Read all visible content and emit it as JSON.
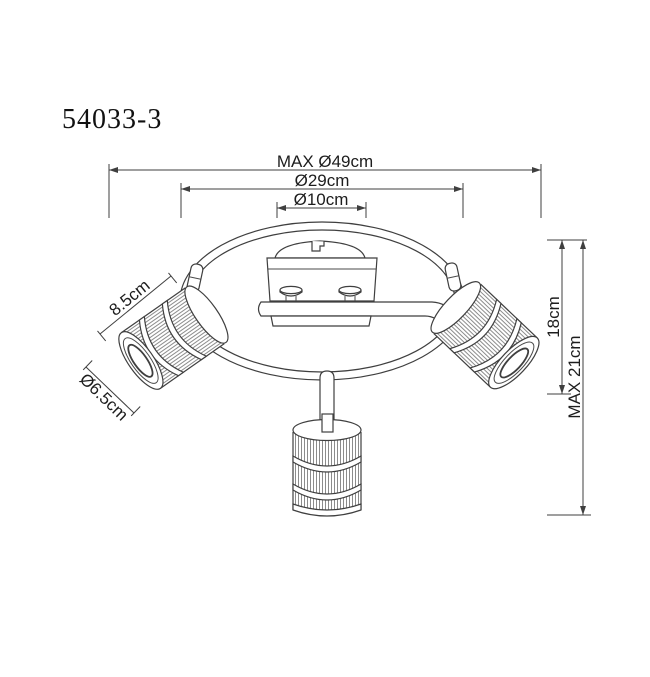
{
  "title": {
    "model_number": "54033-3"
  },
  "drawing": {
    "type": "technical-dimension-diagram",
    "subject": "3-spot ceiling light fixture, spiral ring with three ribbed cylinder shades",
    "colors": {
      "background": "#ffffff",
      "line": "#3f3f3f",
      "text": "#1d1d1d",
      "ribs": "#8c8c8c"
    }
  },
  "dimensions": {
    "overall_diameter": "MAX Ø49cm",
    "ring_diameter": "Ø29cm",
    "canopy_diameter": "Ø10cm",
    "shade_length": "8.5cm",
    "shade_diameter": "Ø6.5cm",
    "body_height": "18cm",
    "max_height": "MAX 21cm"
  }
}
